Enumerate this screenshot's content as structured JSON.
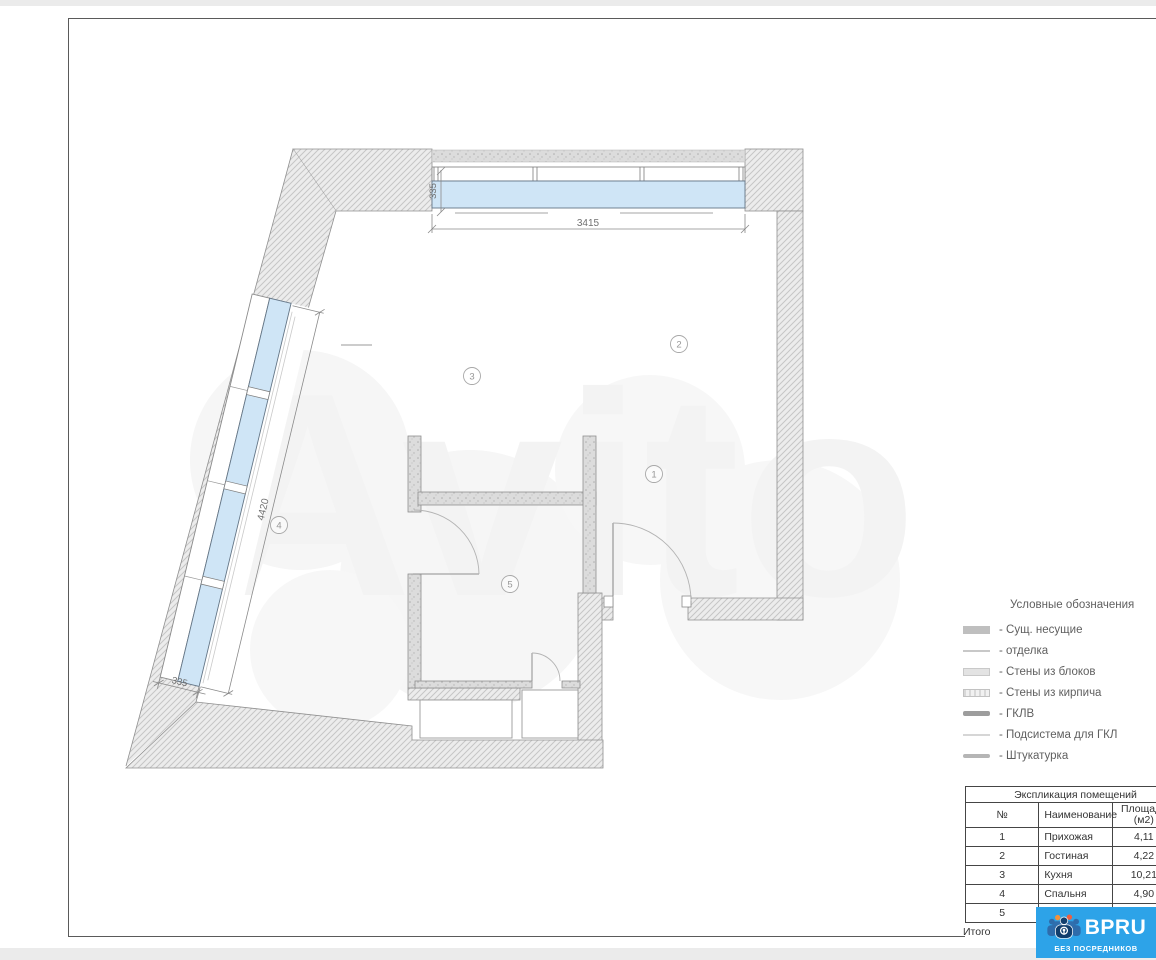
{
  "plan": {
    "watermark": "Avito",
    "dimensions": {
      "top_window_width": "3415",
      "top_window_depth": "335",
      "left_window_length": "4420",
      "left_window_depth": "335"
    },
    "room_labels": {
      "n1": "1",
      "n2": "2",
      "n3": "3",
      "n4": "4",
      "n5": "5"
    }
  },
  "legend": {
    "title": "Условные обозначения",
    "items": [
      {
        "label": "- Сущ. несущие"
      },
      {
        "label": "- отделка"
      },
      {
        "label": "- Стены из блоков"
      },
      {
        "label": "- Стены из кирпича"
      },
      {
        "label": "- ГКЛВ"
      },
      {
        "label": "- Подсистема для ГКЛ"
      },
      {
        "label": "- Штукатурка"
      }
    ]
  },
  "table": {
    "title": "Экспликация помещений",
    "columns": {
      "num": "№",
      "name": "Наименование",
      "area_line1": "Площадь",
      "area_line2": "(м2)"
    },
    "rows": [
      [
        "1",
        "Прихожая",
        "4,11"
      ],
      [
        "2",
        "Гостиная",
        "4,22"
      ],
      [
        "3",
        "Кухня",
        "10,21"
      ],
      [
        "4",
        "Спальня",
        "4,90"
      ],
      [
        "5",
        "С\\У",
        ""
      ]
    ],
    "footer": "Итого"
  },
  "logo": {
    "brand": "BPRU",
    "tagline": "БЕЗ ПОСРЕДНИКОВ"
  },
  "colors": {
    "brand_blue": "#2da3e8",
    "window_glass": "#cfe5f6",
    "wall_hatch": "#ececec",
    "interior_wall": "#dcdcdc"
  }
}
